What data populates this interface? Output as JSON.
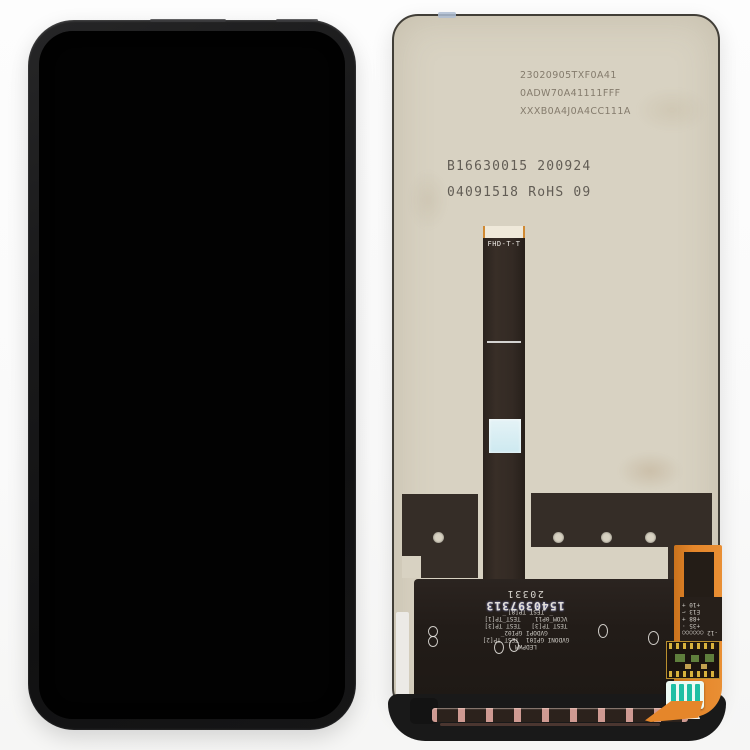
{
  "scene": {
    "background_color": "#fafafa"
  },
  "front_view": {
    "screen_color": "#020202",
    "frame_color": "#1a1a1b"
  },
  "back_view": {
    "plate_color": "#d8d2c2",
    "printed_codes": [
      "23020905TXF0A41",
      "0ADW70A41111FFF",
      "XXXB0A4J0A4CC111A"
    ],
    "etched_codes": [
      "B16630015 200924",
      "04091518 RoHS 09"
    ],
    "flex_ribbon_label": "FHD-T-T",
    "pcb_serial_code": "1540397313",
    "pcb_batch_code": "20331",
    "pcb_test_labels": [
      "LEDPWM",
      "GVDONI GPI01  TEST_TP[2]",
      "GVDOPI GPI02",
      "TEST_TP[3]   TEST_TP[3]",
      "VCOM_0P11    TEST_TP[1]",
      "TEST_TP[8]"
    ],
    "pcb_right_labels": [
      "-12 ○○○○○○",
      "+35 ·",
      "+88 +",
      "E13 ⌐",
      "+10 +"
    ],
    "accent_colors": {
      "flex_orange": "#e5862a",
      "pad_teal": "#1fbfa4",
      "copper": "#cf9a92",
      "inspection_blue": "#cde9f0",
      "dark_flex": "#2b2420"
    }
  }
}
